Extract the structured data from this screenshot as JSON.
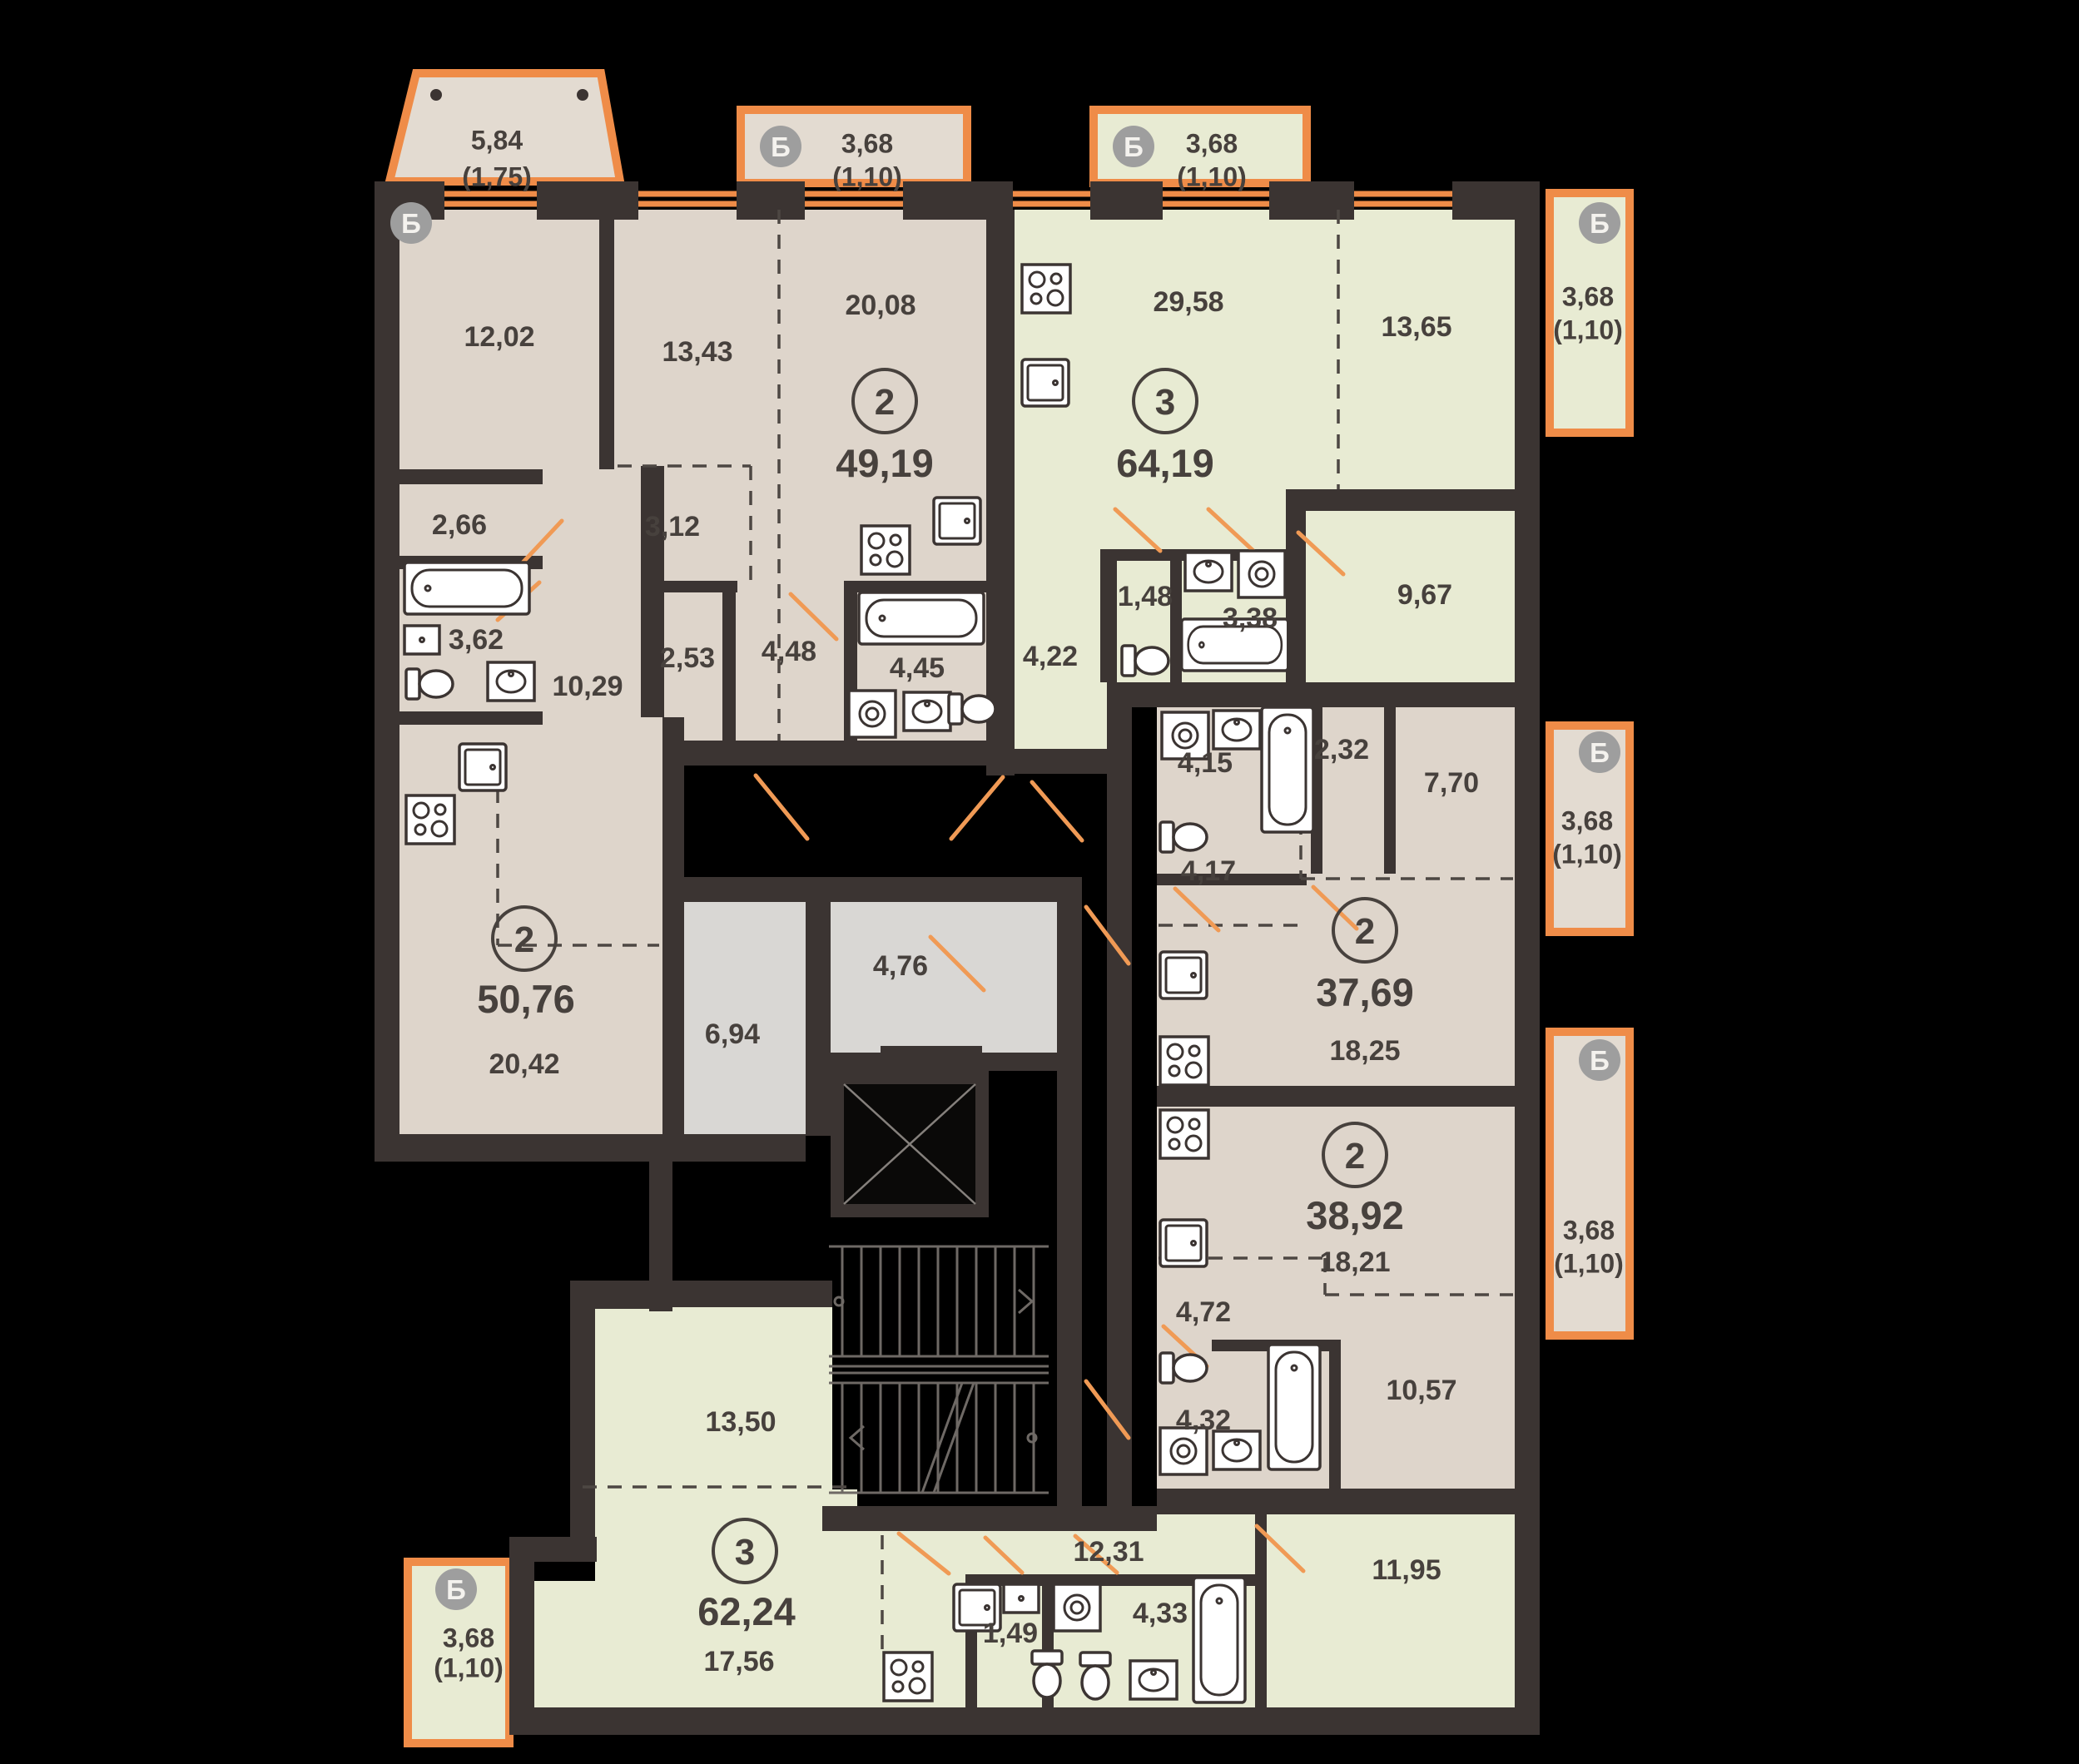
{
  "plan": {
    "title": "floor-plan",
    "colors": {
      "background": "#000000",
      "wall": "#3b3432",
      "window_accent": "#ef8c48",
      "apartment_beige": "#ded5cb",
      "balcony_beige": "#e3dbd1",
      "apartment_green": "#e8ebd3",
      "core_gray": "#d9d7d4",
      "label_text": "#47413d",
      "badge_gray": "#9e9e9e"
    },
    "balconies": [
      {
        "letter": "Б",
        "area": "5,84",
        "coef": "(1,75)",
        "letter_xy": [
          494,
          268
        ],
        "area_xy": [
          597,
          168
        ],
        "coef_xy": [
          597,
          212
        ]
      },
      {
        "letter": "Б",
        "area": "3,68",
        "coef": "(1,10)",
        "letter_xy": [
          938,
          176
        ],
        "area_xy": [
          1042,
          172
        ],
        "coef_xy": [
          1042,
          212
        ]
      },
      {
        "letter": "Б",
        "area": "3,68",
        "coef": "(1,10)",
        "letter_xy": [
          1362,
          176
        ],
        "area_xy": [
          1456,
          172
        ],
        "coef_xy": [
          1456,
          212
        ]
      },
      {
        "letter": "Б",
        "area": "3,68",
        "coef": "(1,10)",
        "letter_xy": [
          1922,
          268
        ],
        "area_xy": [
          1908,
          356
        ],
        "coef_xy": [
          1908,
          396
        ]
      },
      {
        "letter": "Б",
        "area": "3,68",
        "coef": "(1,10)",
        "letter_xy": [
          1922,
          904
        ],
        "area_xy": [
          1907,
          986
        ],
        "coef_xy": [
          1907,
          1026
        ]
      },
      {
        "letter": "Б",
        "area": "3,68",
        "coef": "(1,10)",
        "letter_xy": [
          1922,
          1274
        ],
        "area_xy": [
          1909,
          1478
        ],
        "coef_xy": [
          1909,
          1518
        ]
      },
      {
        "letter": "Б",
        "area": "3,68",
        "coef": "(1,10)",
        "letter_xy": [
          548,
          1910
        ],
        "area_xy": [
          563,
          1968
        ],
        "coef_xy": [
          563,
          2004
        ]
      }
    ],
    "apartments": [
      {
        "type": "2",
        "area": "49,19",
        "circle_xy": [
          1063,
          482
        ],
        "area_xy": [
          1063,
          556
        ],
        "rooms": [
          {
            "label": "13,43",
            "xy": [
              838,
              422
            ]
          },
          {
            "label": "20,08",
            "xy": [
              1058,
              366
            ]
          },
          {
            "label": "3,12",
            "xy": [
              808,
              632
            ]
          },
          {
            "label": "2,53",
            "xy": [
              826,
              790
            ]
          },
          {
            "label": "4,48",
            "xy": [
              948,
              782
            ]
          },
          {
            "label": "4,45",
            "xy": [
              1102,
              802
            ]
          }
        ]
      },
      {
        "type": "3",
        "area": "64,19",
        "circle_xy": [
          1400,
          482
        ],
        "area_xy": [
          1400,
          556
        ],
        "rooms": [
          {
            "label": "29,58",
            "xy": [
              1428,
              362
            ]
          },
          {
            "label": "13,65",
            "xy": [
              1702,
              392
            ]
          },
          {
            "label": "4,22",
            "xy": [
              1262,
              788
            ]
          },
          {
            "label": "1,48",
            "xy": [
              1376,
              716
            ]
          },
          {
            "label": "3,38",
            "xy": [
              1502,
              742
            ]
          },
          {
            "label": "9,67",
            "xy": [
              1712,
              714
            ]
          }
        ]
      },
      {
        "type": "2",
        "area": "50,76",
        "circle_xy": [
          630,
          1128
        ],
        "area_xy": [
          632,
          1200
        ],
        "rooms": [
          {
            "label": "12,02",
            "xy": [
              600,
              404
            ]
          },
          {
            "label": "2,66",
            "xy": [
              552,
              630
            ]
          },
          {
            "label": "3,62",
            "xy": [
              572,
              768
            ]
          },
          {
            "label": "10,29",
            "xy": [
              706,
              824
            ]
          },
          {
            "label": "20,42",
            "xy": [
              630,
              1278
            ]
          }
        ]
      },
      {
        "type": "2",
        "area": "37,69",
        "circle_xy": [
          1640,
          1118
        ],
        "area_xy": [
          1640,
          1192
        ],
        "rooms": [
          {
            "label": "4,15",
            "xy": [
              1448,
              916
            ]
          },
          {
            "label": "2,32",
            "xy": [
              1612,
              900
            ]
          },
          {
            "label": "7,70",
            "xy": [
              1744,
              940
            ]
          },
          {
            "label": "4,17",
            "xy": [
              1452,
              1046
            ]
          },
          {
            "label": "18,25",
            "xy": [
              1640,
              1262
            ]
          }
        ]
      },
      {
        "type": "2",
        "area": "38,92",
        "circle_xy": [
          1628,
          1388
        ],
        "area_xy": [
          1628,
          1460
        ],
        "rooms": [
          {
            "label": "18,21",
            "xy": [
              1628,
              1516
            ]
          },
          {
            "label": "4,72",
            "xy": [
              1446,
              1576
            ]
          },
          {
            "label": "10,57",
            "xy": [
              1708,
              1670
            ]
          },
          {
            "label": "4,32",
            "xy": [
              1446,
              1706
            ]
          }
        ]
      },
      {
        "type": "3",
        "area": "62,24",
        "circle_xy": [
          895,
          1864
        ],
        "area_xy": [
          897,
          1936
        ],
        "rooms": [
          {
            "label": "13,50",
            "xy": [
              890,
              1708
            ]
          },
          {
            "label": "17,56",
            "xy": [
              888,
              1996
            ]
          },
          {
            "label": "12,31",
            "xy": [
              1332,
              1864
            ]
          },
          {
            "label": "1,49",
            "xy": [
              1214,
              1962
            ]
          },
          {
            "label": "4,33",
            "xy": [
              1394,
              1938
            ]
          },
          {
            "label": "11,95",
            "xy": [
              1690,
              1886
            ]
          }
        ]
      }
    ],
    "core_rooms": [
      {
        "label": "6,94",
        "xy": [
          880,
          1242
        ]
      },
      {
        "label": "4,76",
        "xy": [
          1082,
          1160
        ]
      }
    ]
  }
}
